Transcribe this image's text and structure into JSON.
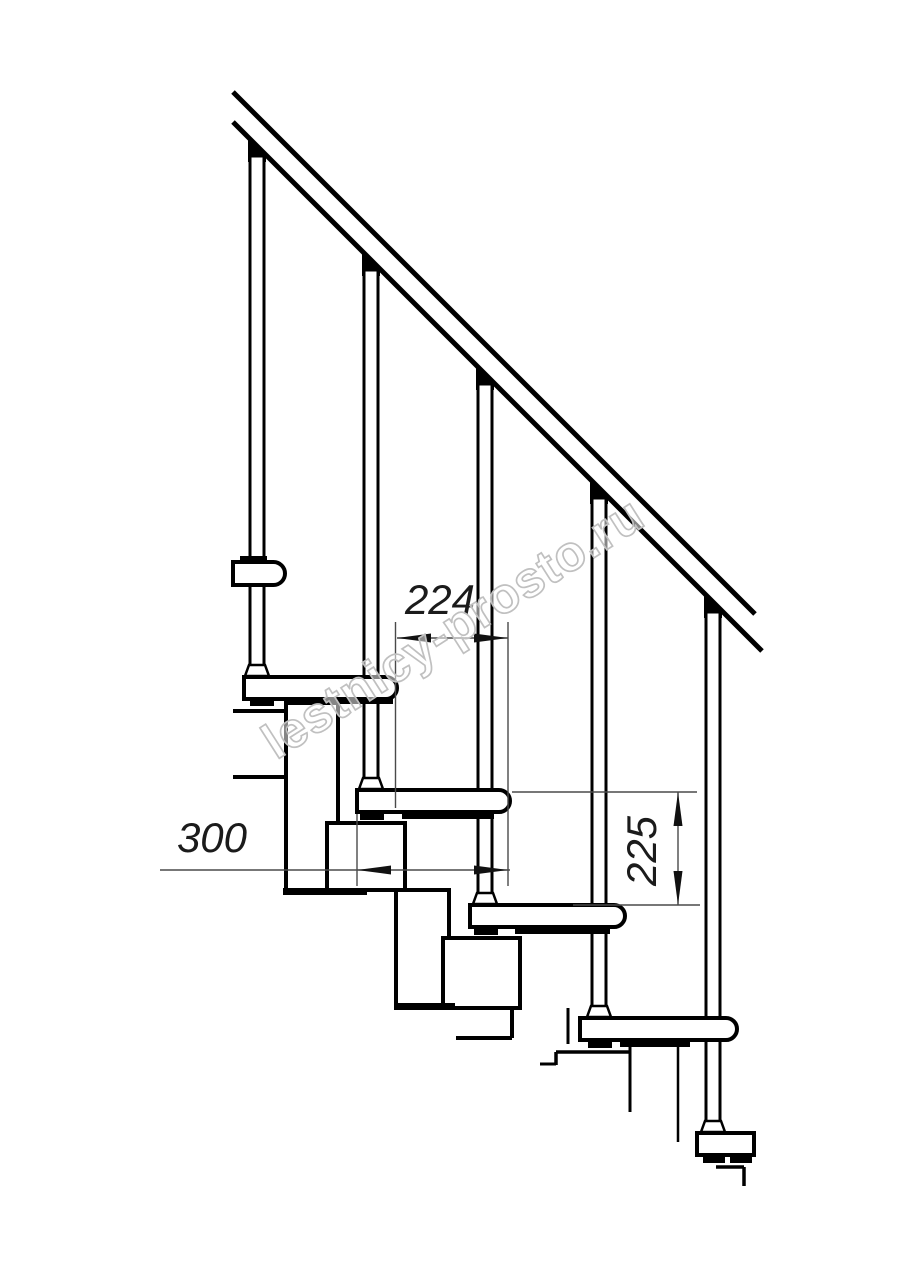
{
  "watermark": {
    "text": "lestnicy-prosto.ru",
    "color": "#c0c0c0",
    "angle_deg": -32.5
  },
  "dimensions": {
    "going_224": {
      "label": "224",
      "line": [
        397,
        638,
        508,
        638
      ],
      "extensions": [
        [
          395.5,
          622,
          395.5,
          808
        ],
        [
          508,
          622,
          508,
          886
        ]
      ],
      "arrows": [
        [
          397,
          638,
          "left"
        ],
        [
          508,
          638,
          "right"
        ]
      ]
    },
    "tread_depth_300": {
      "label": "300",
      "line": [
        160,
        870,
        510,
        870
      ],
      "extensions": [
        [
          357,
          814,
          357,
          886
        ]
      ],
      "arrows": [
        [
          357,
          870,
          "left"
        ],
        [
          508,
          870,
          "right"
        ]
      ]
    },
    "riser_225": {
      "label": "225",
      "line": [
        678,
        792,
        678,
        905
      ],
      "extensions": [
        [
          512,
          792,
          697,
          792
        ],
        [
          573,
          905,
          700,
          905
        ]
      ],
      "arrows": [
        [
          678,
          792,
          "up"
        ],
        [
          678,
          905,
          "down"
        ]
      ]
    }
  },
  "drawing": {
    "stroke_color": "#000000",
    "dim_color": "#4a4a4a",
    "rail_lines": [
      [
        233,
        92,
        755,
        614,
        5
      ],
      [
        233,
        122,
        762,
        651,
        5
      ]
    ],
    "module_blocks": [
      [
        286,
        703,
        52,
        189
      ],
      [
        327,
        823,
        78,
        67
      ],
      [
        396,
        890,
        53,
        117
      ],
      [
        443,
        938,
        77,
        70
      ]
    ],
    "module_lines": [
      [
        233,
        711,
        286,
        711,
        4
      ],
      [
        233,
        777,
        286,
        777,
        4
      ],
      [
        286,
        811,
        338,
        811,
        3.5
      ],
      [
        512,
        1008,
        512,
        1038,
        4
      ],
      [
        456,
        1038,
        512,
        1038,
        4
      ],
      [
        568,
        1008,
        568,
        1044,
        3
      ],
      [
        556,
        1052,
        630,
        1052,
        3.5
      ],
      [
        556,
        1052,
        556,
        1065,
        3.5
      ],
      [
        540,
        1064,
        556,
        1064,
        3
      ],
      [
        630,
        1046,
        630,
        1112,
        3
      ],
      [
        678,
        1045,
        678,
        1142,
        2.5
      ],
      [
        716,
        1167,
        744,
        1167,
        3.5
      ],
      [
        744,
        1167,
        744,
        1186,
        3.5
      ]
    ],
    "balusters": [
      {
        "cx": 257,
        "wedge_y": 146,
        "y1": 156,
        "y2": 666,
        "foot_y": 677
      },
      {
        "cx": 371,
        "wedge_y": 260,
        "y1": 270,
        "y2": 779,
        "foot_y": 790
      },
      {
        "cx": 485,
        "wedge_y": 374,
        "y1": 384,
        "y2": 894,
        "foot_y": 905
      },
      {
        "cx": 599,
        "wedge_y": 488,
        "y1": 498,
        "y2": 1007,
        "foot_y": 1018
      },
      {
        "cx": 713,
        "wedge_y": 602,
        "y1": 612,
        "y2": 1122,
        "foot_y": 1133
      }
    ],
    "treads": [
      [
        233,
        562,
        52,
        23,
        1
      ],
      [
        244,
        677,
        153,
        22,
        1
      ],
      [
        357,
        790,
        153,
        22,
        1
      ],
      [
        470,
        905,
        155,
        22,
        1
      ],
      [
        580,
        1018,
        157,
        22,
        1
      ],
      [
        697,
        1133,
        57,
        22,
        0
      ]
    ],
    "clamp_marks": [
      [
        240,
        556,
        27,
        7
      ],
      [
        283,
        888,
        84,
        7
      ],
      [
        394,
        1003,
        61,
        7
      ],
      [
        250,
        699,
        24,
        7
      ],
      [
        288,
        699,
        105,
        5
      ],
      [
        360,
        814,
        24,
        6
      ],
      [
        402,
        814,
        92,
        5
      ],
      [
        474,
        929,
        24,
        6
      ],
      [
        515,
        929,
        95,
        5
      ],
      [
        588,
        1042,
        24,
        6
      ],
      [
        620,
        1042,
        70,
        5
      ],
      [
        703,
        1157,
        22,
        6
      ],
      [
        730,
        1157,
        22,
        6
      ]
    ]
  }
}
